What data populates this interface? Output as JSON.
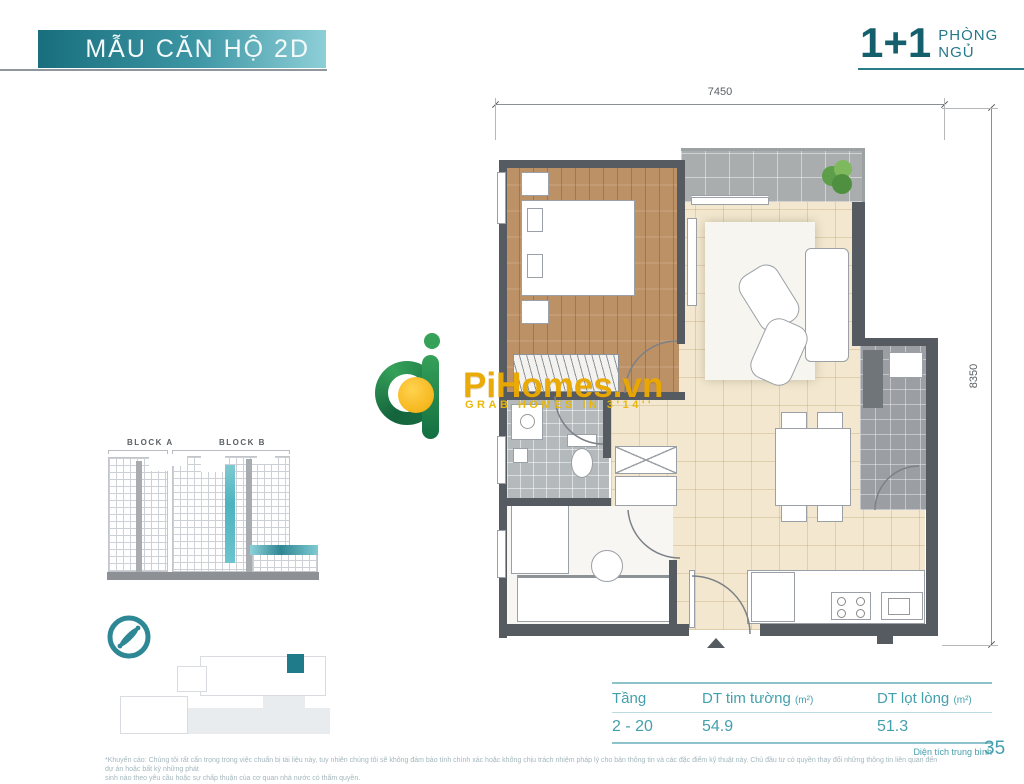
{
  "header": {
    "banner_title": "MẪU CĂN HỘ 2D",
    "unit_badge": {
      "count": "1+1",
      "label_line1": "PHÒNG",
      "label_line2": "NGỦ"
    }
  },
  "floorplan": {
    "dimension_top": "7450",
    "dimension_right": "8350"
  },
  "watermark": {
    "brand": "PiHomes.vn",
    "tagline": "GRAB HOMES IN 3'14''"
  },
  "block_diagram": {
    "block_a_label": "BLOCK A",
    "block_b_label": "BLOCK B"
  },
  "area_table": {
    "col_floor": "Tầng",
    "col_gross": "DT tim tường ",
    "col_gross_unit": "(m²)",
    "col_net": "DT lọt lòng ",
    "col_net_unit": "(m²)",
    "row": {
      "floor": "2 - 20",
      "gross": "54.9",
      "net": "51.3"
    },
    "note": "Diện tích trung bình"
  },
  "footer": {
    "disclaimer_line1": "*Khuyến cáo: Chúng tôi rất cẩn trọng trong việc chuẩn bị tài liệu này, tuy nhiên chúng tôi sẽ không đảm bảo tính chính xác hoặc không chịu trách nhiệm pháp lý cho bản thông tin và các đặc điểm kỹ thuật này. Chủ đầu tư có quyền thay đổi những thông tin liên quan đến dự án hoặc bất kỳ những phát",
    "disclaimer_line2": "sinh nào theo yêu cầu hoặc sự chấp thuận của cơ quan nhà nước có thẩm quyền.",
    "page_number": "35"
  },
  "colors": {
    "accent_teal": "#2a7c89",
    "table_teal": "#44a0ad",
    "banner_gradient_start": "#186e7c",
    "banner_gradient_end": "#8ecfd8",
    "highlight_teal": "#4db3c0",
    "logo_green": "#1e7f49",
    "logo_yellow": "#f2a800",
    "wall_gray": "#565b61",
    "floor_beige": "#f3e8cf",
    "wood_brown": "#bd9166"
  },
  "icons": [
    "compass-icon",
    "plant-icon",
    "entrance-arrow-icon",
    "pihomes-logo-icon"
  ]
}
